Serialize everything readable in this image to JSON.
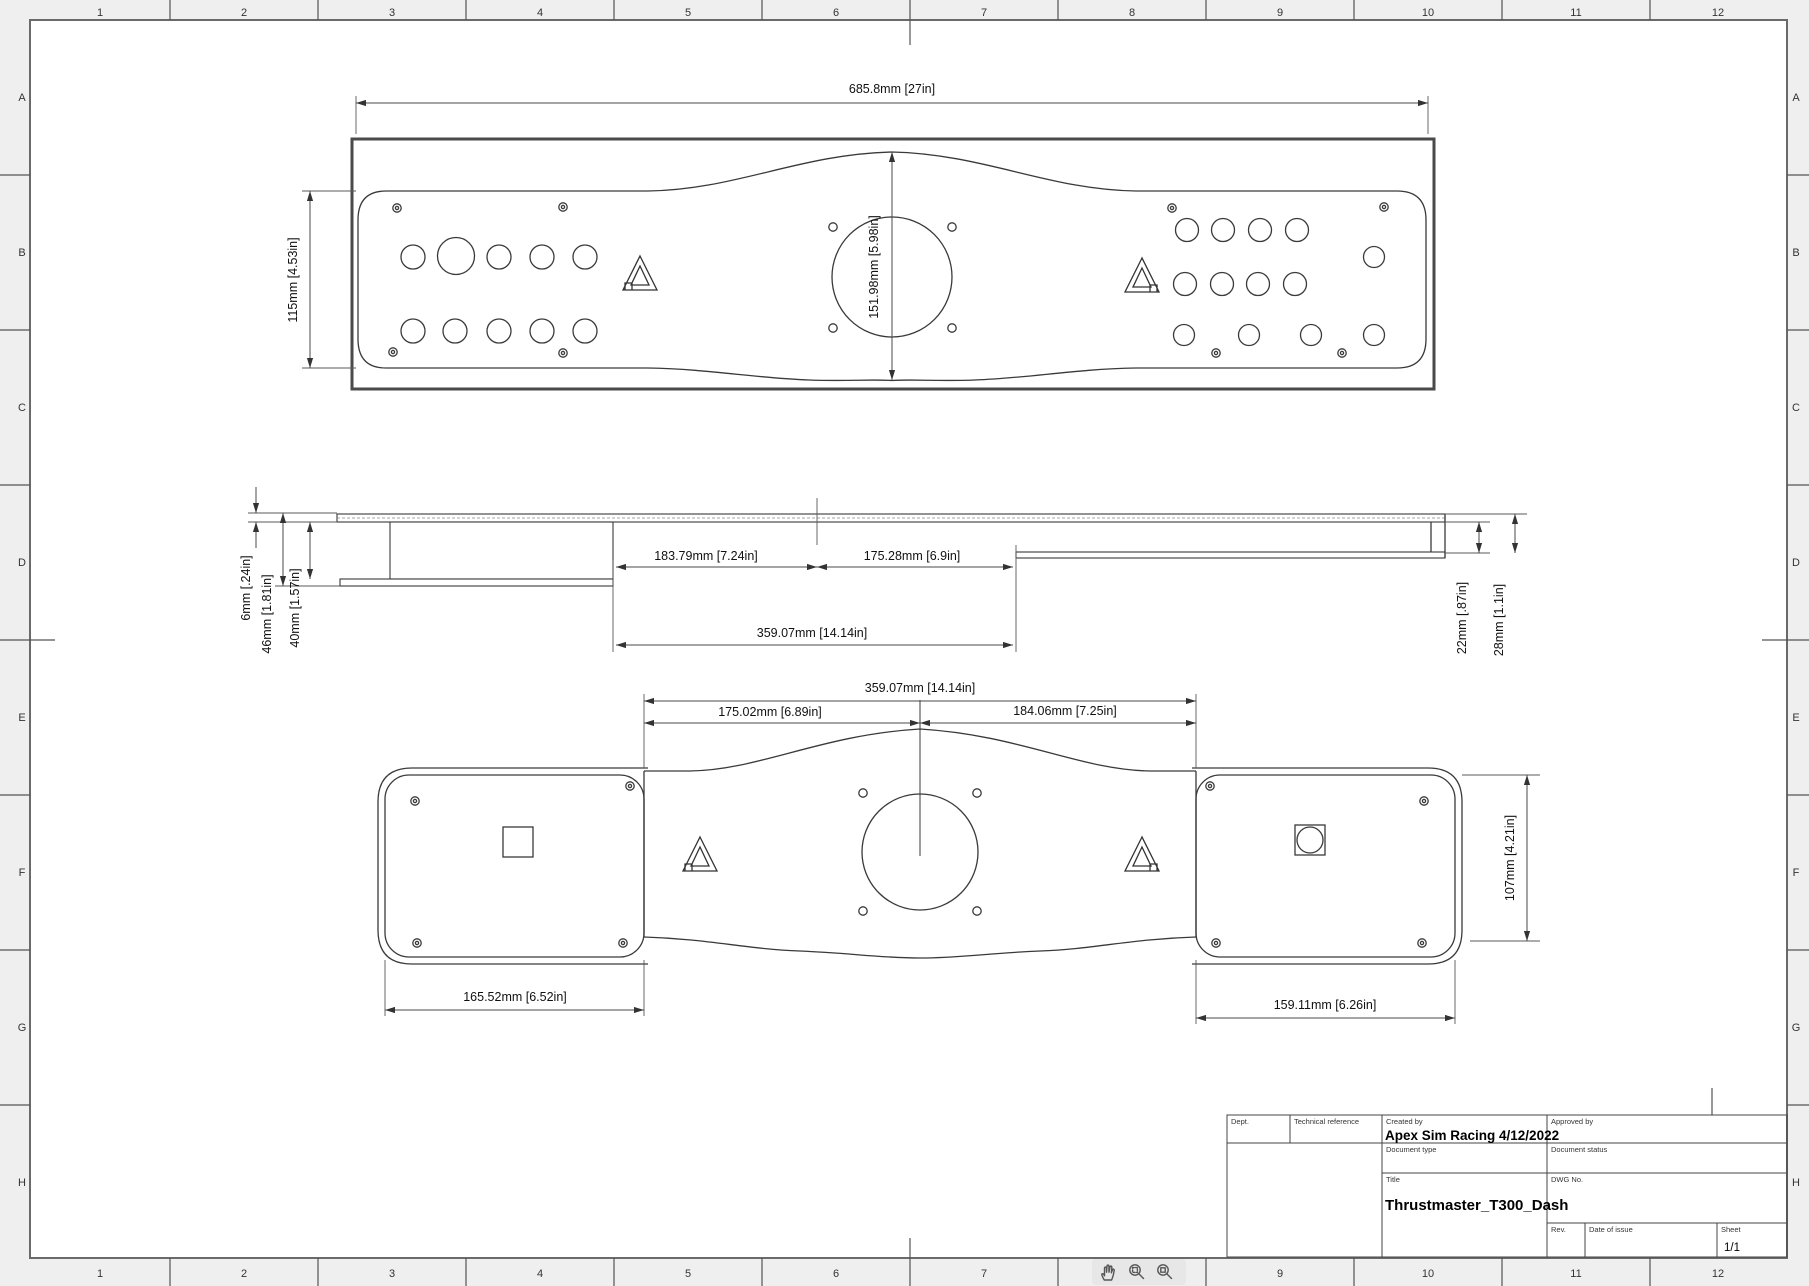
{
  "border": {
    "columns": [
      "1",
      "2",
      "3",
      "4",
      "5",
      "6",
      "7",
      "8",
      "9",
      "10",
      "11",
      "12"
    ],
    "rows": [
      "A",
      "B",
      "C",
      "D",
      "E",
      "F",
      "G",
      "H"
    ]
  },
  "views": {
    "top": {
      "dims": {
        "width": "685.8mm [27in]",
        "height": "115mm [4.53in]",
        "center_height": "151.98mm [5.98in]"
      }
    },
    "side": {
      "dims": {
        "thickness": "6mm [.24in]",
        "bracket_front": "46mm [1.81in]",
        "bracket_back": "40mm [1.57in]",
        "left_half": "183.79mm [7.24in]",
        "right_half": "175.28mm [6.9in]",
        "total": "359.07mm [14.14in]",
        "step_depth": "22mm [.87in]",
        "step_height": "28mm [1.1in]"
      }
    },
    "flat": {
      "dims": {
        "total": "359.07mm [14.14in]",
        "left_half": "175.02mm [6.89in]",
        "right_half": "184.06mm [7.25in]",
        "left_panel": "165.52mm [6.52in]",
        "right_panel": "159.11mm [6.26in]",
        "panel_height": "107mm [4.21in]"
      }
    }
  },
  "title_block": {
    "dept_label": "Dept.",
    "tech_ref_label": "Technical reference",
    "created_by_label": "Created by",
    "created_by_value": "Apex Sim Racing 4/12/2022",
    "approved_by_label": "Approved by",
    "doc_type_label": "Document type",
    "doc_status_label": "Document status",
    "title_label": "Title",
    "title_value": "Thrustmaster_T300_Dash",
    "dwg_label": "DWG No.",
    "rev_label": "Rev.",
    "date_label": "Date of issue",
    "sheet_label": "Sheet",
    "sheet_value": "1/1"
  },
  "toolbar": {
    "icons": [
      {
        "name": "pan-hand-icon"
      },
      {
        "name": "zoom-window-icon"
      },
      {
        "name": "zoom-fit-icon"
      }
    ]
  }
}
